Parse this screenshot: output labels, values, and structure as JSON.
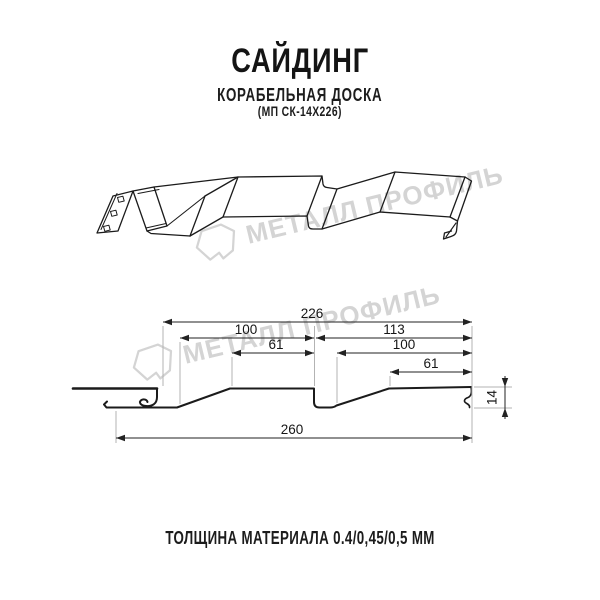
{
  "header": {
    "title": "САЙДИНГ",
    "subtitle": "КОРАБЕЛЬНАЯ ДОСКА",
    "code": "(МП СК-14Х226)"
  },
  "watermark": {
    "brand": "МЕТАЛЛ ПРОФИЛЬ",
    "color": "#d4d4d4"
  },
  "section": {
    "dims": {
      "total_top": "226",
      "board1_top": "100",
      "board1_inner": "61",
      "board2_top": "113",
      "board2_mid": "100",
      "board2_inner": "61",
      "height": "14",
      "total_bottom": "260"
    }
  },
  "footer": {
    "text": "ТОЛЩИНА МАТЕРИАЛА 0.4/0,45/0,5 ММ"
  },
  "colors": {
    "profile_line": "#1b1b1b",
    "dimension_line": "#222222",
    "extension_line": "#b3b3b3",
    "text": "#1c1c1c",
    "watermark": "#d4d4d4",
    "background": "#ffffff"
  }
}
